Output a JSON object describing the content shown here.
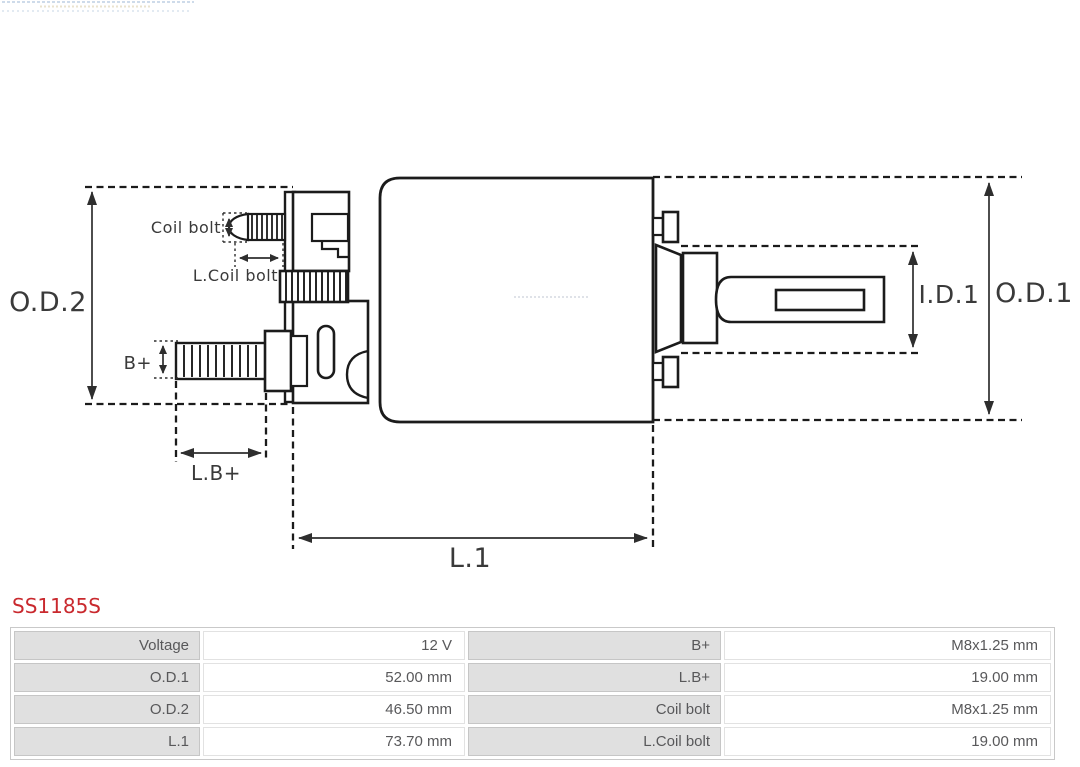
{
  "product": {
    "code": "SS1185S"
  },
  "diagram": {
    "labels": {
      "od2": "O.D.2",
      "od1": "O.D.1",
      "id1": "I.D.1",
      "l1": "L.1",
      "lb": "L.B+",
      "bplus": "B+",
      "coil_bolt": "Coil bolt",
      "l_coil_bolt": "L.Coil bolt"
    }
  },
  "table": {
    "rows": [
      {
        "label": "Voltage",
        "value": "12 V",
        "label2": "B+",
        "value2": "M8x1.25 mm"
      },
      {
        "label": "O.D.1",
        "value": "52.00 mm",
        "label2": "L.B+",
        "value2": "19.00 mm"
      },
      {
        "label": "O.D.2",
        "value": "46.50 mm",
        "label2": "Coil bolt",
        "value2": "M8x1.25 mm"
      },
      {
        "label": "L.1",
        "value": "73.70 mm",
        "label2": "L.Coil bolt",
        "value2": "19.00 mm"
      }
    ]
  },
  "colors": {
    "code_red": "#c9292e",
    "drawing_line": "#1b1b1b",
    "dimension_line": "#2e2e2e",
    "table_label_bg": "#e0e0e0",
    "table_border": "#c9c9c9",
    "table_text": "#58585a"
  }
}
